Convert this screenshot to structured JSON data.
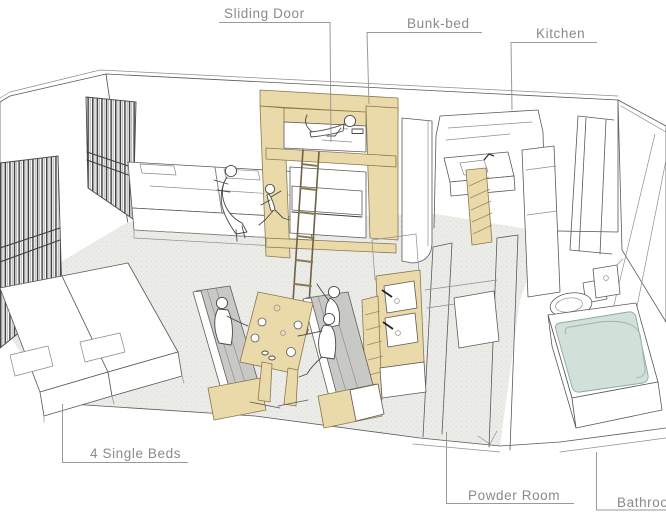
{
  "labels": {
    "sliding_door": "Sliding Door",
    "bunk_bed": "Bunk-bed",
    "kitchen": "Kitchen",
    "single_beds": "4 Single Beds",
    "powder_room": "Powder Room",
    "bathroom": "Bathroom"
  },
  "colors": {
    "background": "#ffffff",
    "sketch_line": "#5a5a5a",
    "label_text": "#8a8a8a",
    "wood_accent": "#ead9a9",
    "cushion_gray": "#c8c8c5",
    "bath_water": "#cfe1d8",
    "floor_gray": "#ebebe8"
  }
}
